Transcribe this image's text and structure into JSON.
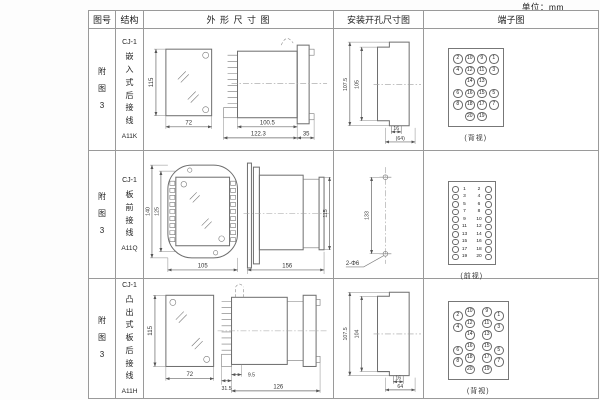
{
  "page": {
    "unit_label": "单位：mm"
  },
  "headers": {
    "fig_no": "图号",
    "structure": "结构",
    "outline": "外 形 尺 寸 图",
    "mounting": "安装开孔尺寸图",
    "terminal": "端子图"
  },
  "rows": [
    {
      "fig_no": "附\n图\n3",
      "model": "CJ-1",
      "mount_type": "嵌\n入\n式\n后\n接\n线",
      "code": "A11K",
      "outline": {
        "front_h": "115",
        "front_w": "72",
        "len_body": "100.5",
        "len_total": "122.3",
        "len_flange": "35"
      },
      "mounting": {
        "outer_h": "107.5",
        "inner_h": "105",
        "slot_w": "16",
        "total_w": "(64)"
      },
      "terminal": {
        "view_label": "(背视)",
        "style": "grid",
        "rows": [
          [
            "2",
            "10",
            "9",
            "1"
          ],
          [
            "4",
            "12",
            "11",
            "3"
          ],
          [
            "",
            "14",
            "13",
            ""
          ],
          [
            "6",
            "16",
            "15",
            "5"
          ],
          [
            "8",
            "18",
            "17",
            "7"
          ],
          [
            "",
            "20",
            "19",
            ""
          ]
        ]
      }
    },
    {
      "fig_no": "附\n图\n3",
      "model": "CJ-1",
      "mount_type": "板\n前\n接\n线",
      "code": "A11Q",
      "outline": {
        "front_outer_h": "140",
        "front_inner_h": "125",
        "front_w": "105",
        "side_len": "156",
        "side_h": "115"
      },
      "mounting": {
        "hole_dist": "133",
        "hole_callout": "2-Φ6"
      },
      "terminal": {
        "view_label": "(前视)",
        "style": "pairs",
        "rows": [
          [
            "1",
            "2"
          ],
          [
            "3",
            "4"
          ],
          [
            "5",
            "6"
          ],
          [
            "7",
            "8"
          ],
          [
            "9",
            "10"
          ],
          [
            "11",
            "12"
          ],
          [
            "13",
            "14"
          ],
          [
            "15",
            "16"
          ],
          [
            "17",
            "18"
          ],
          [
            "19",
            "20"
          ]
        ]
      }
    },
    {
      "fig_no": "附\n图\n3",
      "model": "CJ-1",
      "mount_type": "凸\n出\n式\n板\n后\n接\n线",
      "code": "A11H",
      "outline": {
        "front_h": "115",
        "front_w": "72",
        "comb_w": "31.5",
        "gap": "9.5",
        "len_total": "126"
      },
      "mounting": {
        "outer_h": "107.5",
        "inner_h": "104",
        "slot_w": "16",
        "total_w": "64"
      },
      "terminal": {
        "view_label": "(背视)",
        "style": "staggered",
        "rows": [
          [
            "2",
            "10",
            "9",
            "1"
          ],
          [
            "4",
            "12",
            "11",
            "3"
          ],
          [
            "",
            "14",
            "13",
            ""
          ],
          [
            "6",
            "16",
            "15",
            "5"
          ],
          [
            "8",
            "18",
            "17",
            "7"
          ],
          [
            "",
            "20",
            "19",
            ""
          ]
        ]
      }
    }
  ]
}
